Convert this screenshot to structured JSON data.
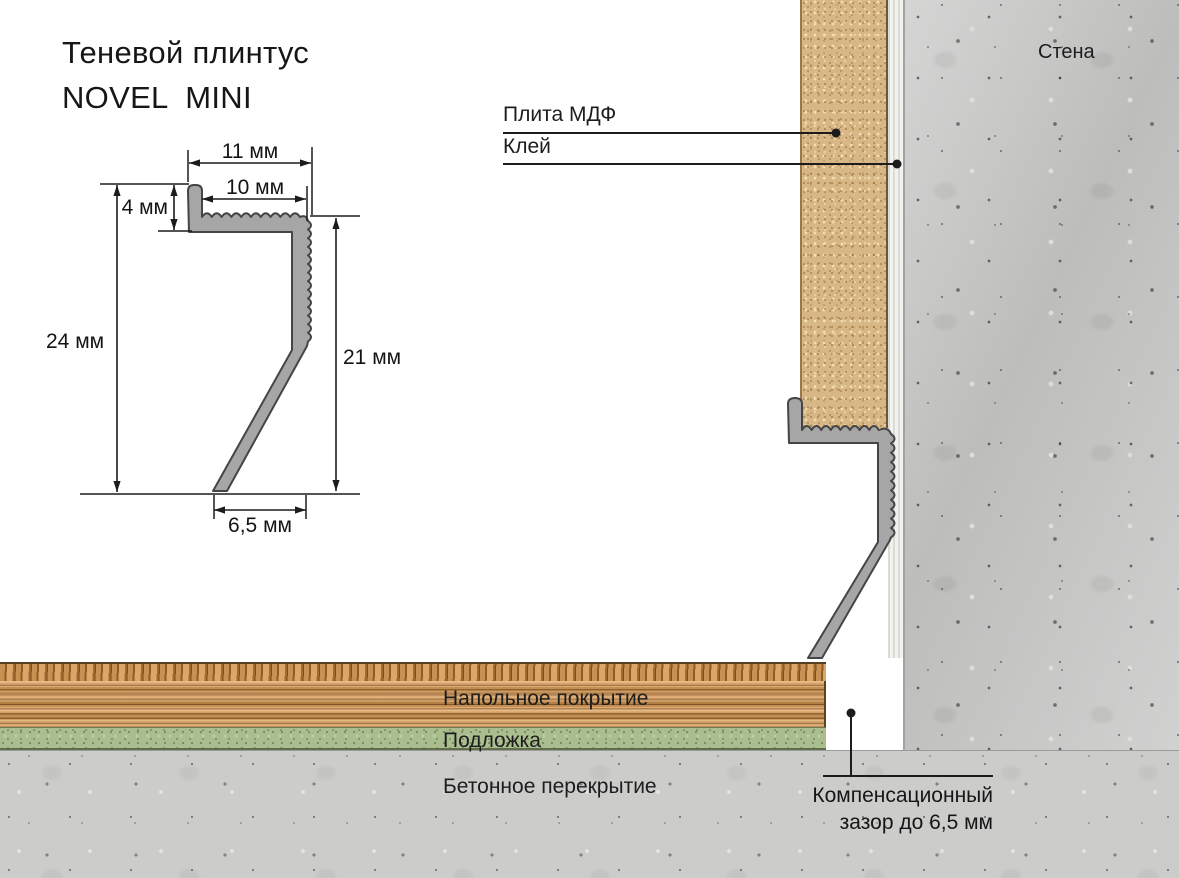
{
  "title": {
    "line1": "Теневой плинтус",
    "line2": "NOVEL  MINI"
  },
  "profile_drawing": {
    "name": "profile-cross-section",
    "dims": {
      "top_width": "11 мм",
      "inner_width": "10 мм",
      "lip_height": "4 мм",
      "total_height": "24 мм",
      "right_height": "21 мм",
      "bottom_width": "6,5 мм"
    }
  },
  "section": {
    "wall_label": "Стена",
    "mdf_label": "Плита МДФ",
    "glue_label": "Клей",
    "floor_label": "Напольное покрытие",
    "underlay_label": "Подложка",
    "slab_label": "Бетонное перекрытие",
    "gap_label_line1": "Компенсационный",
    "gap_label_line2": "зазор до 6,5 мм"
  },
  "colors": {
    "profile_metal": "#a6a6a6",
    "profile_outline": "#454545",
    "mdf_tan": "#d8b787",
    "wall_concrete": "#c7c8c6",
    "slab_concrete": "#cccdca",
    "wood_floor": "#d09253",
    "underlay_green": "#a9bd8e",
    "glue_white": "#f2f2ee",
    "line_ink": "#1c1c1c"
  }
}
